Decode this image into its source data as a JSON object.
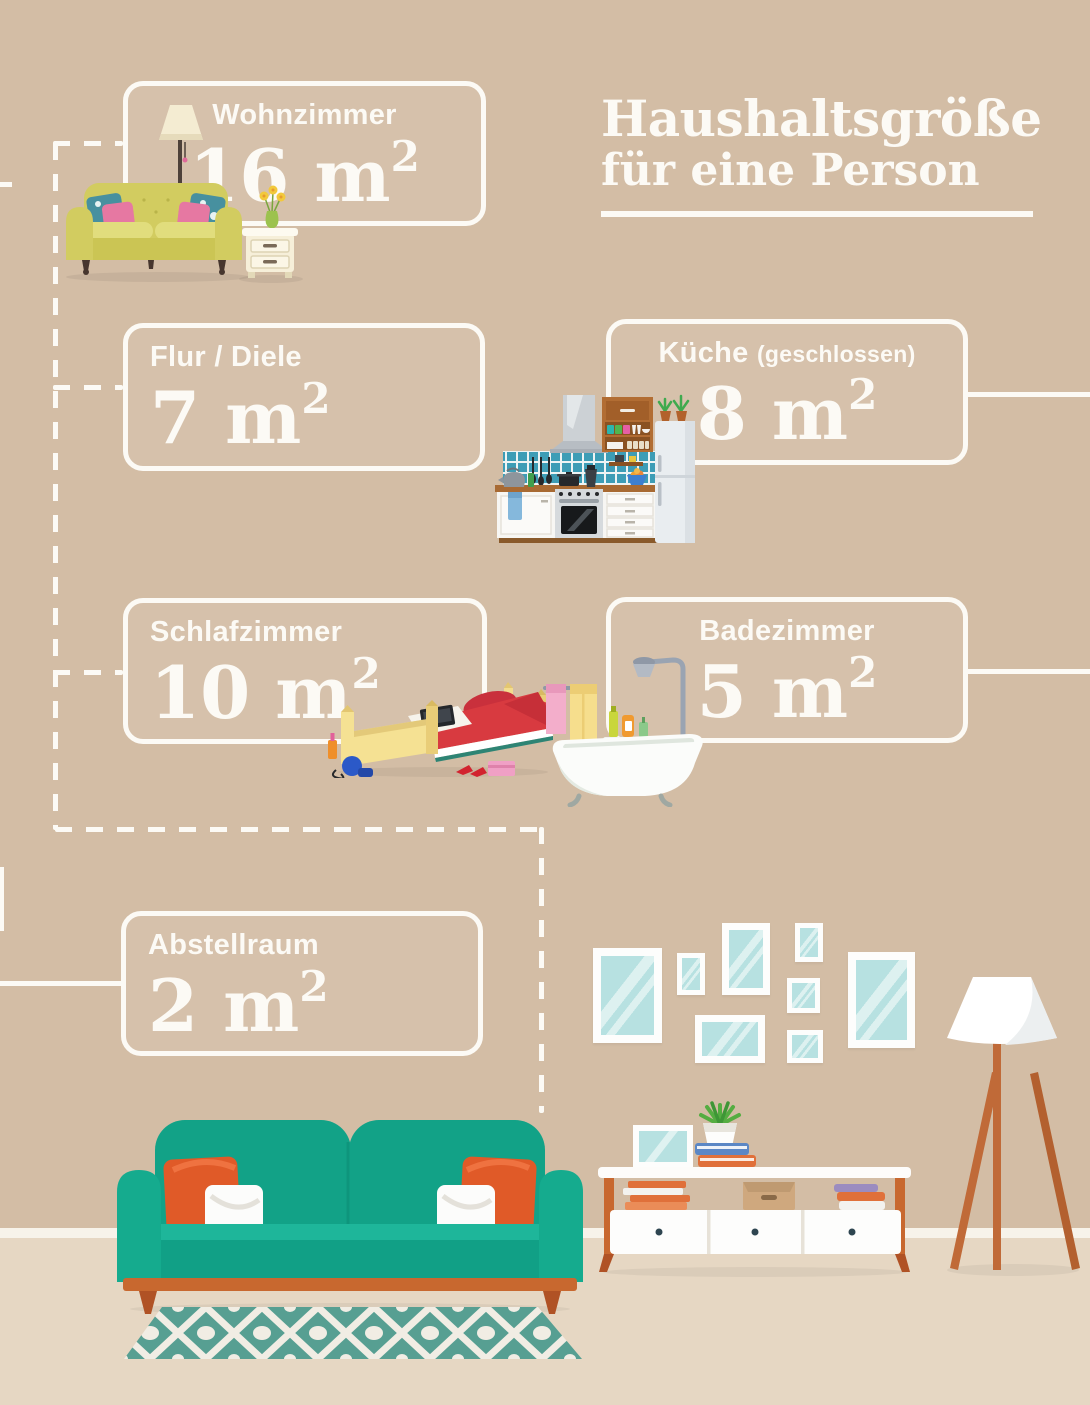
{
  "title": {
    "line1": "Haushaltsgröße",
    "line2": "für eine Person"
  },
  "rooms": [
    {
      "name": "Wohnzimmer",
      "area": "16 m",
      "area_exponent": "2"
    },
    {
      "name": "Flur / Diele",
      "area": "7 m",
      "area_exponent": "2"
    },
    {
      "name": "Küche",
      "qualifier": "(geschlossen)",
      "area": "8 m",
      "area_exponent": "2"
    },
    {
      "name": "Schlafzimmer",
      "area": "10 m",
      "area_exponent": "2"
    },
    {
      "name": "Badezimmer",
      "area": "5 m",
      "area_exponent": "2"
    },
    {
      "name": "Abstellraum",
      "area": "2 m",
      "area_exponent": "2"
    }
  ],
  "illustrations": {
    "wohnzimmer": "olive-sofa-floor-lamp-nightstand",
    "kueche": "kitchen-unit-with-fridge",
    "schlafzimmer": "messy-bed-with-laptop",
    "badezimmer": "clawfoot-bathtub-shower",
    "bottom_scene": [
      "teal-sofa",
      "patterned-rug",
      "gallery-picture-frames",
      "sideboard",
      "tripod-floor-lamp"
    ]
  },
  "colors": {
    "wall": "#d3bda5",
    "floor": "#e6d7c3",
    "line_white": "#fcfaf5",
    "sofa_teal": "#12a287",
    "wood_orange": "#c8682f",
    "pillow_orange": "#e05a28",
    "rug_teal": "#579f92",
    "frame_glass_blue": "#b7e1e1",
    "olive_sofa": "#d2cc60",
    "bed_red": "#d83a40",
    "accent_pink": "#e678a2"
  }
}
